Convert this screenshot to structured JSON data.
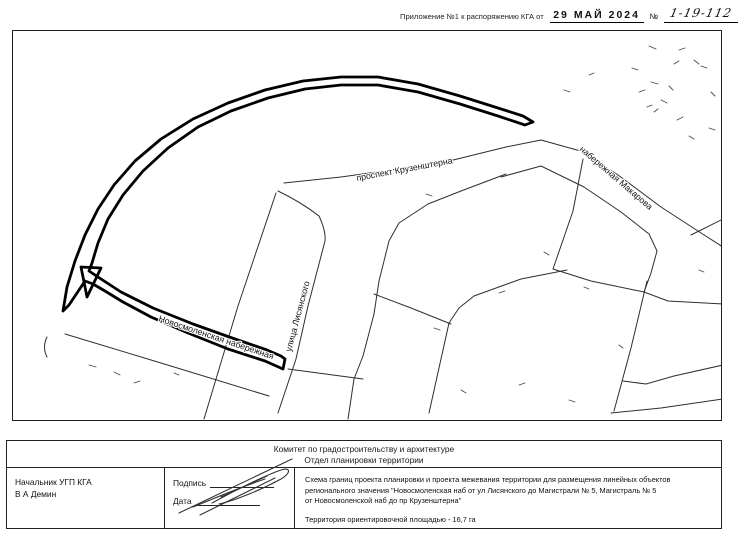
{
  "header": {
    "label": "Приложение №1 к распоряжению КГА от",
    "date_stamp": "29 МАЙ 2024",
    "number_sign": "№",
    "number_value": "1-19-112"
  },
  "map": {
    "street_labels": {
      "kruzenshterna": "проспект Крузенштерна",
      "makarova": "набережная Макарова",
      "lisyanskogo": "улица Лисянского",
      "novosmolenskaya": "Новосмоленская набережная"
    }
  },
  "title_block": {
    "org_line1": "Комитет по градостроительству и архитектуре",
    "org_line2": "Отдел планировки территории",
    "official_position": "Начальник УГП КГА",
    "official_name": "В А  Демин",
    "signature_label": "Подпись",
    "date_label": "Дата",
    "description_line1": "Схема границ проекта планировки и проекта межевания территории для размещения линейных объектов",
    "description_line2": "регионального значения \"Новосмоленская наб  от ул  Лисянского до Магистрали № 5, Магистраль № 5",
    "description_line3": "от Новосмоленской наб  до пр  Крузенштерна\"",
    "area_line": "Территория  ориентировочной площадью - 16,7 га"
  }
}
